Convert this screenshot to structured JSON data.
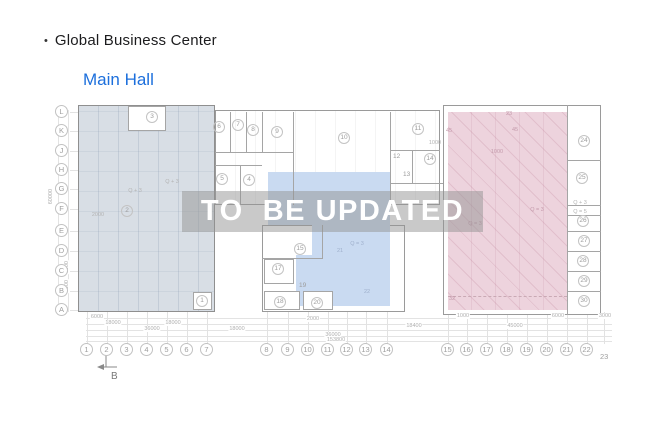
{
  "header": {
    "bullet": "•",
    "title": "Global Business Center",
    "subtitle": "Main Hall",
    "subtitle_color": "#1c6fdc"
  },
  "overlay": {
    "text": "TO  BE UPDATED"
  },
  "section_marker": {
    "label": "B"
  },
  "plan": {
    "colors": {
      "left_region": "#d8dee5",
      "blue_region": "#c9daf1",
      "pink_region": "#edd3dd",
      "wall": "#a5a5a5"
    },
    "row_labels": [
      {
        "label": "L",
        "x": 62,
        "y": 112
      },
      {
        "label": "K",
        "x": 62,
        "y": 131
      },
      {
        "label": "J",
        "x": 62,
        "y": 151
      },
      {
        "label": "H",
        "x": 62,
        "y": 170
      },
      {
        "label": "G",
        "x": 62,
        "y": 189
      },
      {
        "label": "F",
        "x": 62,
        "y": 209
      },
      {
        "label": "E",
        "x": 62,
        "y": 231
      },
      {
        "label": "D",
        "x": 62,
        "y": 251
      },
      {
        "label": "C",
        "x": 62,
        "y": 271
      },
      {
        "label": "B",
        "x": 62,
        "y": 291
      },
      {
        "label": "A",
        "x": 62,
        "y": 310
      }
    ],
    "col_labels": [
      {
        "label": "1",
        "x": 87,
        "y": 350
      },
      {
        "label": "2",
        "x": 107,
        "y": 350
      },
      {
        "label": "3",
        "x": 127,
        "y": 350
      },
      {
        "label": "4",
        "x": 147,
        "y": 350
      },
      {
        "label": "5",
        "x": 167,
        "y": 350
      },
      {
        "label": "6",
        "x": 187,
        "y": 350
      },
      {
        "label": "7",
        "x": 207,
        "y": 350
      },
      {
        "label": "8",
        "x": 267,
        "y": 350
      },
      {
        "label": "9",
        "x": 288,
        "y": 350
      },
      {
        "label": "10",
        "x": 308,
        "y": 350
      },
      {
        "label": "11",
        "x": 328,
        "y": 350
      },
      {
        "label": "12",
        "x": 347,
        "y": 350
      },
      {
        "label": "13",
        "x": 366,
        "y": 350
      },
      {
        "label": "14",
        "x": 387,
        "y": 350
      },
      {
        "label": "15",
        "x": 448,
        "y": 350
      },
      {
        "label": "16",
        "x": 467,
        "y": 350
      },
      {
        "label": "17",
        "x": 487,
        "y": 350
      },
      {
        "label": "18",
        "x": 507,
        "y": 350
      },
      {
        "label": "19",
        "x": 527,
        "y": 350
      },
      {
        "label": "20",
        "x": 547,
        "y": 350
      },
      {
        "label": "21",
        "x": 567,
        "y": 350
      },
      {
        "label": "22",
        "x": 587,
        "y": 350
      },
      {
        "label": "23",
        "x": 604,
        "y": 356,
        "plain": true
      }
    ],
    "rooms": [
      {
        "n": "1",
        "x": 202,
        "y": 301
      },
      {
        "n": "2",
        "x": 127,
        "y": 211
      },
      {
        "n": "3",
        "x": 152,
        "y": 117
      },
      {
        "n": "4",
        "x": 249,
        "y": 180
      },
      {
        "n": "5",
        "x": 222,
        "y": 179
      },
      {
        "n": "6",
        "x": 219,
        "y": 127
      },
      {
        "n": "7",
        "x": 238,
        "y": 125
      },
      {
        "n": "8",
        "x": 253,
        "y": 130
      },
      {
        "n": "9",
        "x": 277,
        "y": 132
      },
      {
        "n": "10",
        "x": 344,
        "y": 138
      },
      {
        "n": "11",
        "x": 418,
        "y": 129
      },
      {
        "n": "12",
        "x": 396,
        "y": 157,
        "plain": true
      },
      {
        "n": "13",
        "x": 406,
        "y": 175,
        "plain": true
      },
      {
        "n": "14",
        "x": 430,
        "y": 159
      },
      {
        "n": "15",
        "x": 300,
        "y": 249
      },
      {
        "n": "17",
        "x": 278,
        "y": 269
      },
      {
        "n": "18",
        "x": 280,
        "y": 302
      },
      {
        "n": "19",
        "x": 302,
        "y": 286,
        "plain": true
      },
      {
        "n": "20",
        "x": 317,
        "y": 303
      },
      {
        "n": "21",
        "x": 340,
        "y": 252,
        "plain": true,
        "c": "blue"
      },
      {
        "n": "22",
        "x": 367,
        "y": 293,
        "plain": true,
        "c": "blue"
      },
      {
        "n": "24",
        "x": 584,
        "y": 141
      },
      {
        "n": "25",
        "x": 582,
        "y": 178
      },
      {
        "n": "26",
        "x": 583,
        "y": 221
      },
      {
        "n": "27",
        "x": 584,
        "y": 241
      },
      {
        "n": "28",
        "x": 583,
        "y": 261
      },
      {
        "n": "29",
        "x": 584,
        "y": 281
      },
      {
        "n": "30",
        "x": 584,
        "y": 301
      }
    ],
    "annotations": [
      {
        "t": "Q + 3",
        "x": 172,
        "y": 182
      },
      {
        "t": "Q + 3",
        "x": 135,
        "y": 191
      },
      {
        "t": "2000",
        "x": 98,
        "y": 215
      },
      {
        "t": "Q = 3",
        "x": 357,
        "y": 244,
        "c": "blue"
      },
      {
        "t": "Q = 3",
        "x": 537,
        "y": 210,
        "c": "pink"
      },
      {
        "t": "Q = 3",
        "x": 475,
        "y": 224,
        "c": "pink"
      },
      {
        "t": "Q + 3",
        "x": 580,
        "y": 203
      },
      {
        "t": "Q = 5",
        "x": 580,
        "y": 212
      },
      {
        "t": "23",
        "x": 509,
        "y": 114,
        "c": "pink"
      },
      {
        "t": "45",
        "x": 449,
        "y": 131,
        "c": "pink"
      },
      {
        "t": "45",
        "x": 515,
        "y": 130,
        "c": "pink"
      },
      {
        "t": "1000",
        "x": 497,
        "y": 152,
        "c": "pink"
      },
      {
        "t": "1000",
        "x": 435,
        "y": 143
      },
      {
        "t": "32",
        "x": 452,
        "y": 299,
        "c": "pink"
      }
    ],
    "dimensions": [
      {
        "t": "6000",
        "x": 97,
        "y": 318
      },
      {
        "t": "2000",
        "x": 313,
        "y": 320
      },
      {
        "t": "1000",
        "x": 463,
        "y": 317
      },
      {
        "t": "6000",
        "x": 558,
        "y": 317
      },
      {
        "t": "3000",
        "x": 605,
        "y": 317
      },
      {
        "t": "18000",
        "x": 113,
        "y": 324
      },
      {
        "t": "18000",
        "x": 173,
        "y": 324
      },
      {
        "t": "18400",
        "x": 414,
        "y": 327
      },
      {
        "t": "45000",
        "x": 515,
        "y": 327
      },
      {
        "t": "36000",
        "x": 152,
        "y": 330
      },
      {
        "t": "18000",
        "x": 237,
        "y": 330
      },
      {
        "t": "36000",
        "x": 333,
        "y": 336
      },
      {
        "t": "153800",
        "x": 336,
        "y": 341
      }
    ],
    "v_dimensions": [
      {
        "t": "60000",
        "x": 52,
        "y": 200
      },
      {
        "t": "6000",
        "x": 68,
        "y": 272
      },
      {
        "t": "6000",
        "x": 68,
        "y": 291
      }
    ],
    "walls": [
      {
        "x": 230,
        "y": 112,
        "w": 1,
        "h": 40
      },
      {
        "x": 246,
        "y": 112,
        "w": 1,
        "h": 40
      },
      {
        "x": 262,
        "y": 112,
        "w": 1,
        "h": 41
      },
      {
        "x": 293,
        "y": 112,
        "w": 1,
        "h": 93
      },
      {
        "x": 390,
        "y": 112,
        "w": 1,
        "h": 93
      },
      {
        "x": 215,
        "y": 152,
        "w": 79,
        "h": 1
      },
      {
        "x": 215,
        "y": 165,
        "w": 47,
        "h": 1
      },
      {
        "x": 240,
        "y": 165,
        "w": 1,
        "h": 40
      },
      {
        "x": 390,
        "y": 150,
        "w": 50,
        "h": 1
      },
      {
        "x": 412,
        "y": 150,
        "w": 1,
        "h": 33
      },
      {
        "x": 390,
        "y": 183,
        "w": 53,
        "h": 1
      },
      {
        "x": 262,
        "y": 258,
        "w": 60,
        "h": 1
      },
      {
        "x": 322,
        "y": 225,
        "w": 1,
        "h": 34
      },
      {
        "x": 567,
        "y": 105,
        "w": 1,
        "h": 210
      },
      {
        "x": 567,
        "y": 160,
        "w": 34,
        "h": 1
      },
      {
        "x": 567,
        "y": 205,
        "w": 34,
        "h": 1
      },
      {
        "x": 567,
        "y": 215,
        "w": 34,
        "h": 1
      },
      {
        "x": 567,
        "y": 231,
        "w": 34,
        "h": 1
      },
      {
        "x": 567,
        "y": 251,
        "w": 34,
        "h": 1
      },
      {
        "x": 567,
        "y": 271,
        "w": 34,
        "h": 1
      },
      {
        "x": 567,
        "y": 291,
        "w": 34,
        "h": 1
      }
    ],
    "dim_lines_y": [
      318,
      324,
      330,
      336,
      341
    ],
    "v_dim_lines_x": [
      58,
      68
    ]
  }
}
